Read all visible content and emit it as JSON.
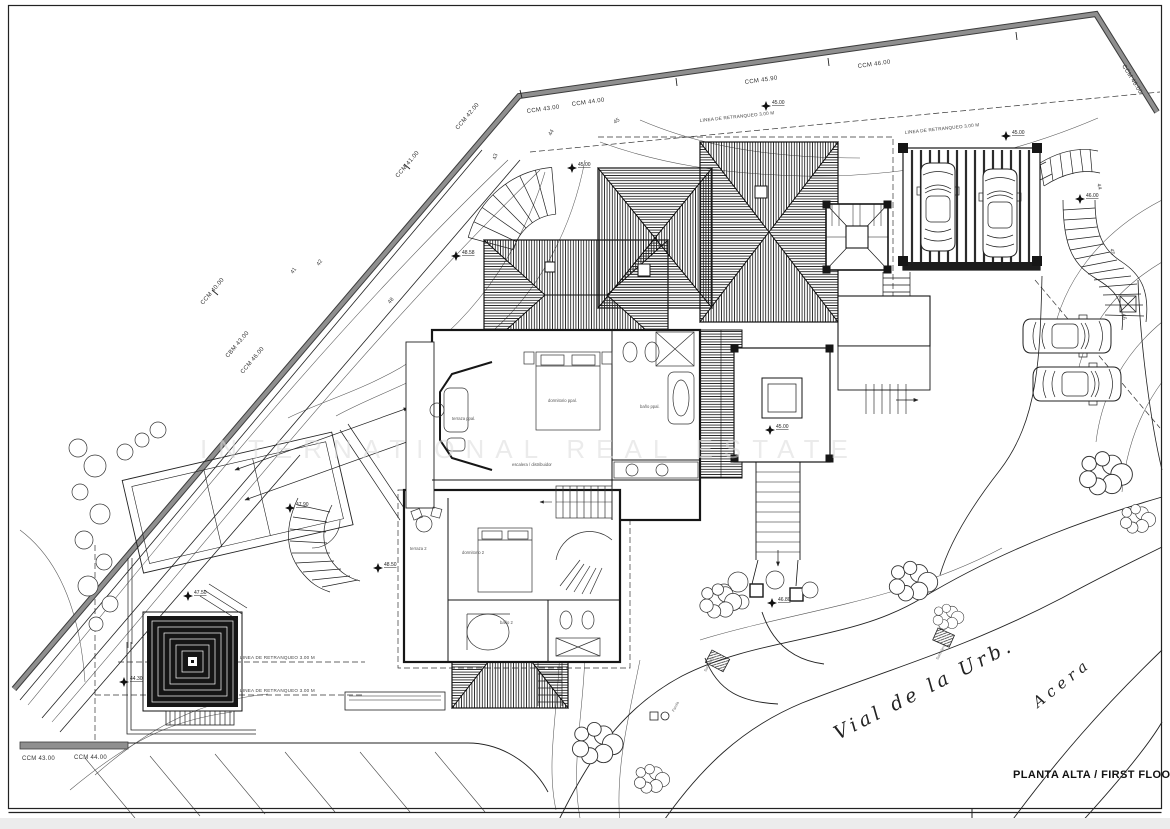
{
  "title_block": {
    "title": "PLANTA ALTA / FIRST FLOOR"
  },
  "watermark": "INTERNATIONAL REAL ESTATE",
  "streets": {
    "road_name": "Vial de la Urb.",
    "sidewalk_name": "Acera"
  },
  "wall_marks": [
    "CCM 40.00",
    "CCM 41.00",
    "CCM 42.00",
    "CCM 43.00",
    "CCM 44.00",
    "CCM 45.90",
    "CCM 46.00",
    "CCM 46.00",
    "CBM 43.00",
    "CCM 46.00",
    "CCM 43.00",
    "CCM 44.00"
  ],
  "contour_marks": [
    "41",
    "42",
    "43",
    "44",
    "45",
    "44",
    "45",
    "46",
    "48"
  ],
  "spot_levels": [
    "45.00",
    "45.00",
    "48.58",
    "45.00",
    "46.00",
    "45.00",
    "47.90",
    "47.50",
    "48.50",
    "44.30",
    "46.80"
  ],
  "rooms": [
    "terraza ppal.",
    "dormitorio ppal.",
    "baño ppal.",
    "escalera / distribuidor",
    "terraza 2",
    "dormitorio 2",
    "baño 2"
  ],
  "site_labels": {
    "setback": "LINEA DE RETRANQUEO 3.00 M",
    "drain": "Sumidero",
    "lamp": "Farola"
  },
  "colors": {
    "boundary_wall_gray": "#8f8f8f",
    "linework": "#1a1a1a",
    "contour": "#555555",
    "roof_hatch": "#1d1d1d",
    "watermark": "#dcdcdc"
  }
}
